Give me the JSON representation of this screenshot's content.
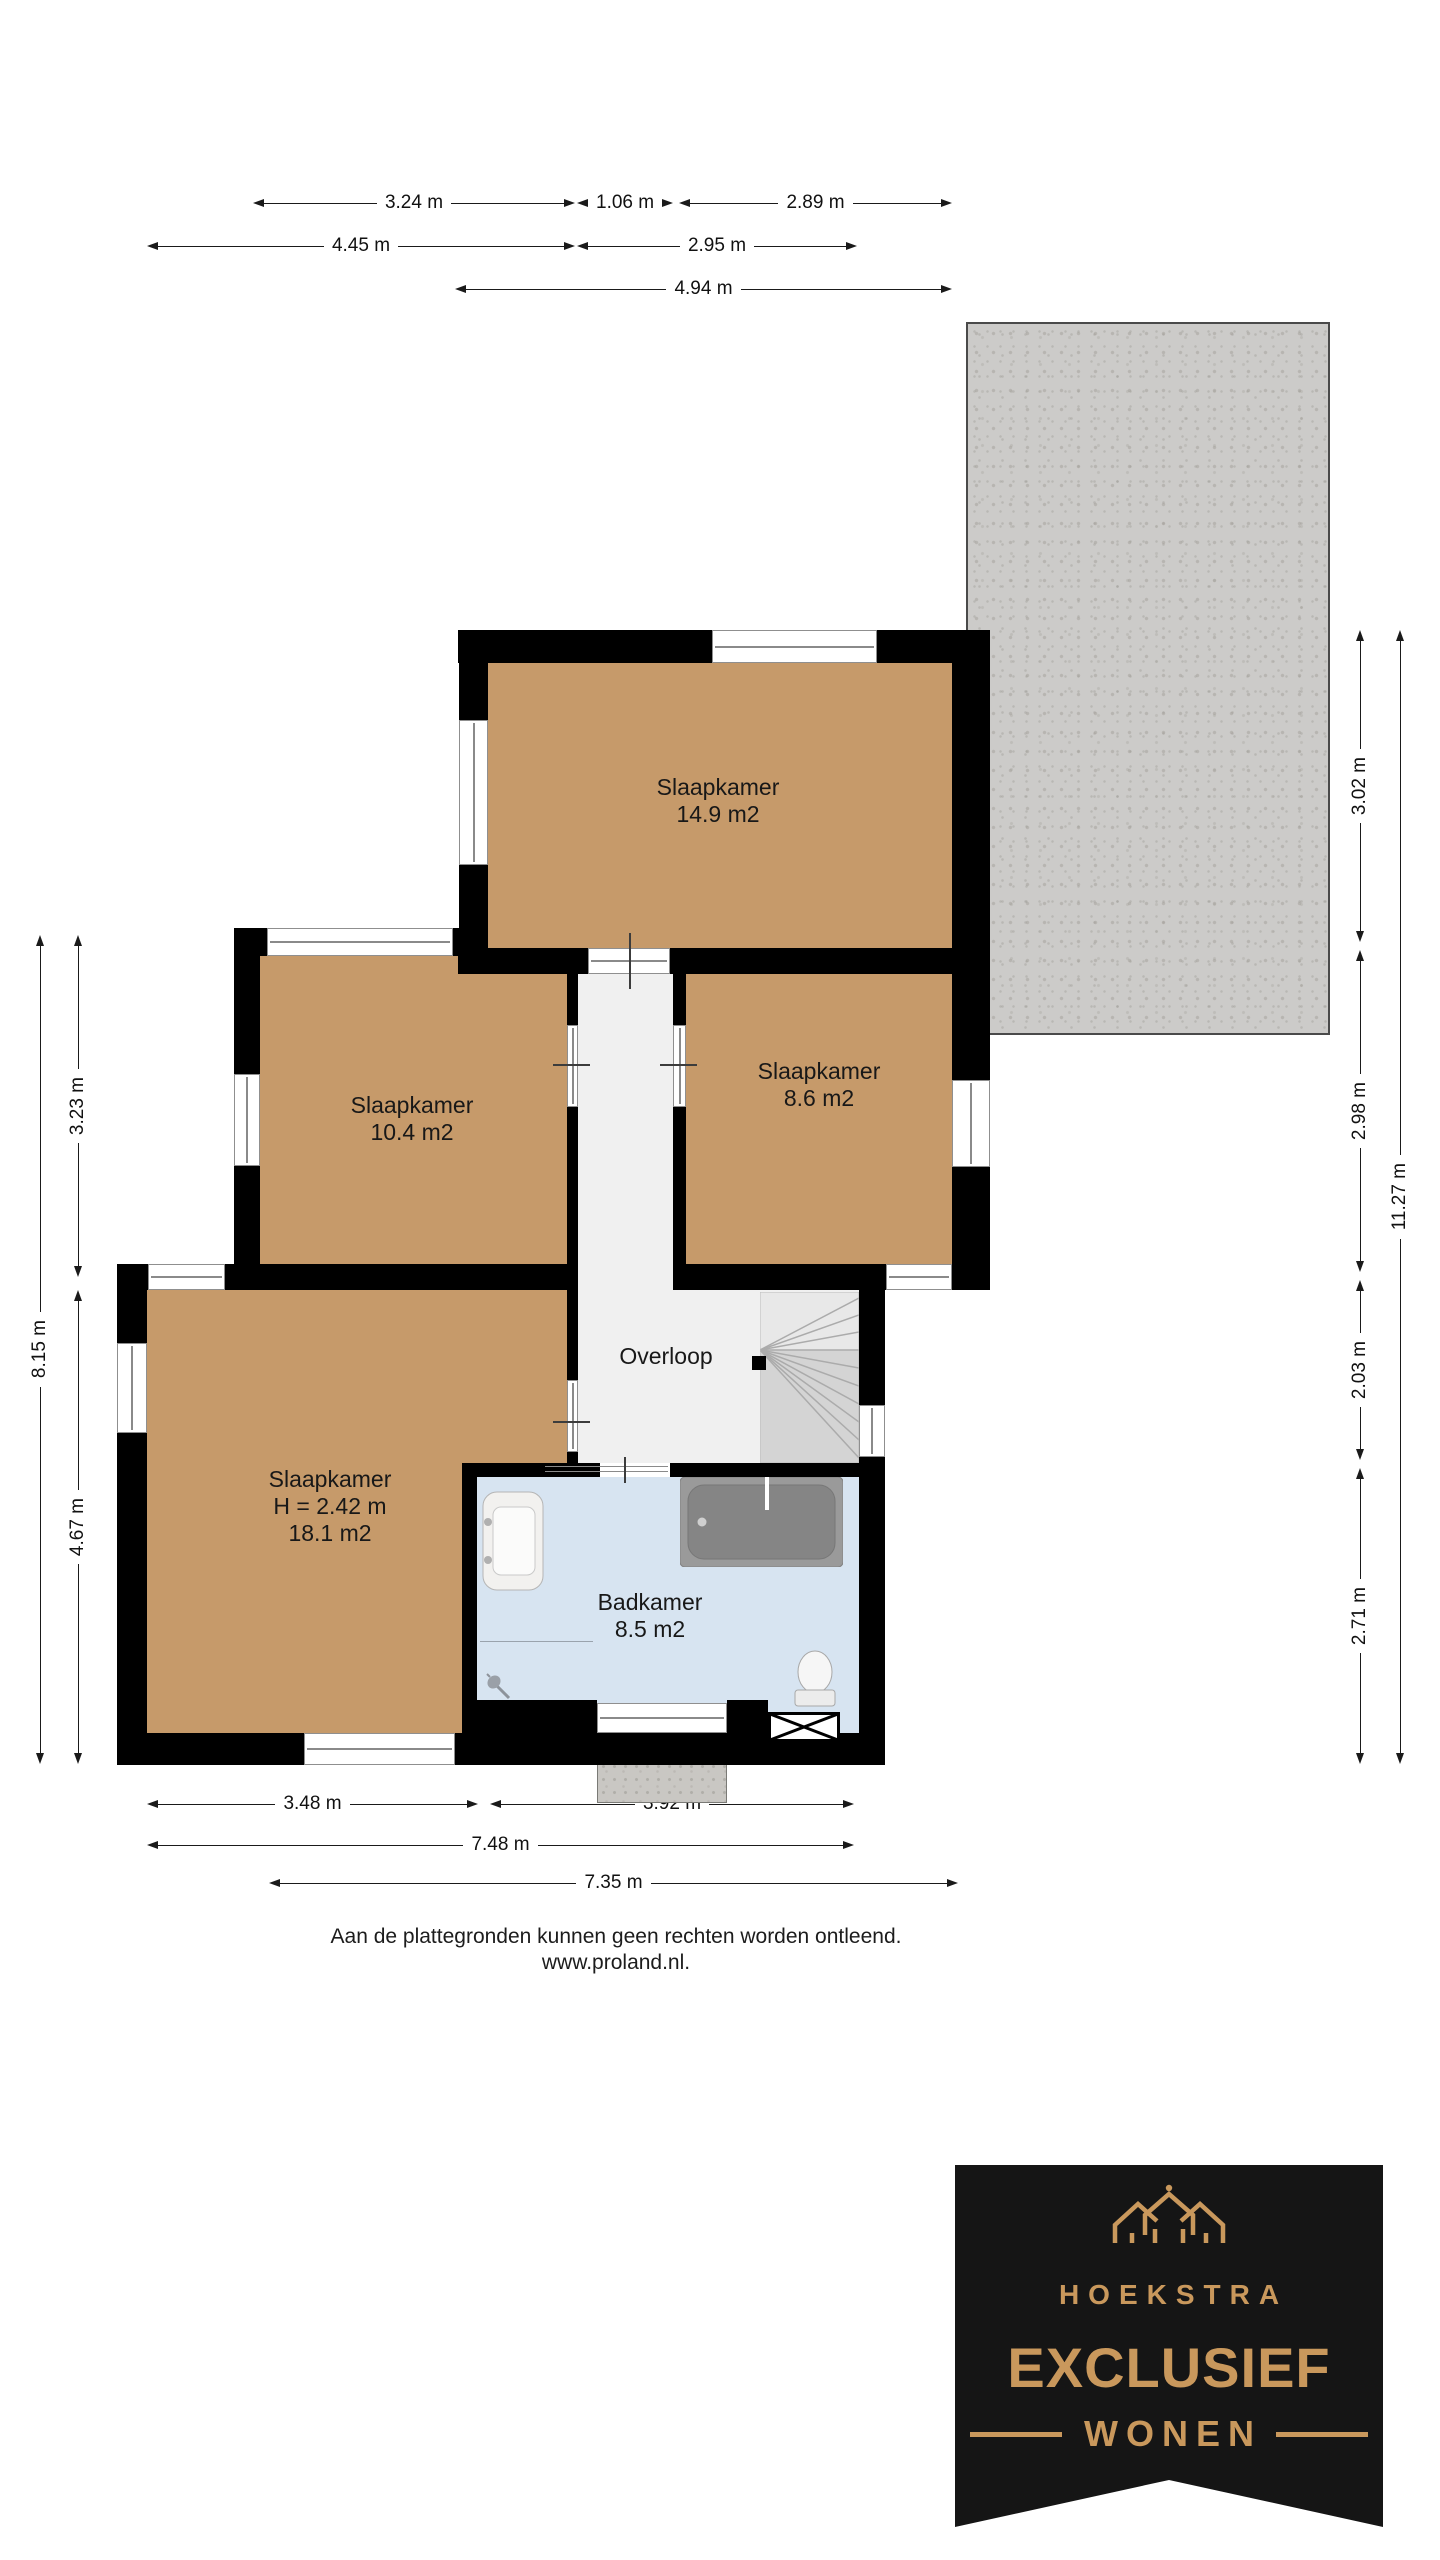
{
  "colors": {
    "wall": "#000000",
    "floor_tan": "#C69A6A",
    "bathroom_blue": "#D7E4F1",
    "hall_gray": "#F0F0F0",
    "roof_gray": "#CCCBC9",
    "logo_gold": "#C9985C",
    "logo_bg": "#151515"
  },
  "rooms": {
    "bedroom_top": {
      "name": "Slaapkamer",
      "area": "14.9 m2"
    },
    "bedroom_left": {
      "name": "Slaapkamer",
      "area": "10.4 m2"
    },
    "bedroom_right": {
      "name": "Slaapkamer",
      "area": "8.6 m2"
    },
    "bedroom_master": {
      "name": "Slaapkamer",
      "ceiling_height": "H = 2.42 m",
      "area": "18.1 m2"
    },
    "landing": {
      "name": "Overloop"
    },
    "bathroom": {
      "name": "Badkamer",
      "area": "8.5 m2"
    }
  },
  "dimensions": {
    "top_row1": [
      {
        "label": "3.24 m"
      },
      {
        "label": "1.06 m"
      },
      {
        "label": "2.89 m"
      }
    ],
    "top_row2": [
      {
        "label": "4.45 m"
      },
      {
        "label": "2.95 m"
      }
    ],
    "top_row3": [
      {
        "label": "4.94 m"
      }
    ],
    "bottom_row1": [
      {
        "label": "3.48 m"
      },
      {
        "label": "3.92 m"
      }
    ],
    "bottom_row2": [
      {
        "label": "7.48 m"
      }
    ],
    "bottom_row3": [
      {
        "label": "7.35 m"
      }
    ],
    "left_inner": [
      {
        "label": "3.23 m"
      },
      {
        "label": "4.67 m"
      }
    ],
    "left_outer": [
      {
        "label": "8.15 m"
      }
    ],
    "right_inner": [
      {
        "label": "3.02 m"
      },
      {
        "label": "2.98 m"
      },
      {
        "label": "2.03 m"
      },
      {
        "label": "2.71 m"
      }
    ],
    "right_outer": [
      {
        "label": "11.27 m"
      }
    ]
  },
  "fixtures": {
    "bathtub": "bathtub",
    "sink": "sink",
    "toilet": "toilet",
    "shower": "shower-head",
    "stairs": "staircase",
    "hatch": "roof-hatch",
    "house": "house-icon"
  },
  "footer": {
    "disclaimer_line1": "Aan de plattegronden kunnen geen rechten worden ontleend.",
    "disclaimer_line2": "www.proland.nl."
  },
  "logo": {
    "brand": "HOEKSTRA",
    "title": "EXCLUSIEF",
    "subtitle": "WONEN"
  }
}
